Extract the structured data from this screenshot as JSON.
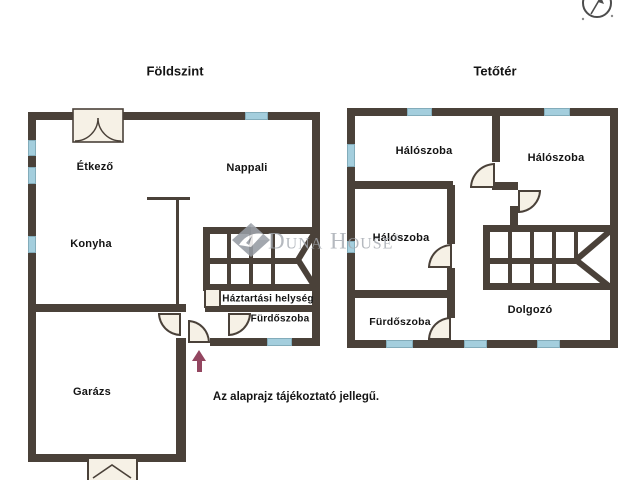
{
  "titles": {
    "ground": "Földszint",
    "attic": "Tetőtér"
  },
  "rooms": {
    "ground": {
      "etkezo": "Étkező",
      "nappali": "Nappali",
      "konyha": "Konyha",
      "haztartasi": "Háztartási helység",
      "furdo": "Fürdőszoba",
      "garazs": "Garázs"
    },
    "attic": {
      "halo1": "Hálószoba",
      "halo2": "Hálószoba",
      "halo3": "Hálószoba",
      "furdo": "Fürdőszoba",
      "dolgozo": "Dolgozó"
    }
  },
  "watermark": {
    "brand": "Duna House",
    "registered": "®"
  },
  "disclaimer": "Az alaprajz tájékoztató jellegű.",
  "icons": {
    "compass": "compass-north-icon",
    "entrance_arrow": "entrance-arrow-icon",
    "stairs": "stairs-symbol",
    "logo": "duna-house-diamond-logo"
  },
  "colors": {
    "background": "#ffffff",
    "wall": "#4a4139",
    "window": "#a4cedd",
    "door_fill": "#f6f1e6",
    "text": "#141414",
    "watermark": "#a5aab1",
    "entrance_arrow": "#934660"
  }
}
